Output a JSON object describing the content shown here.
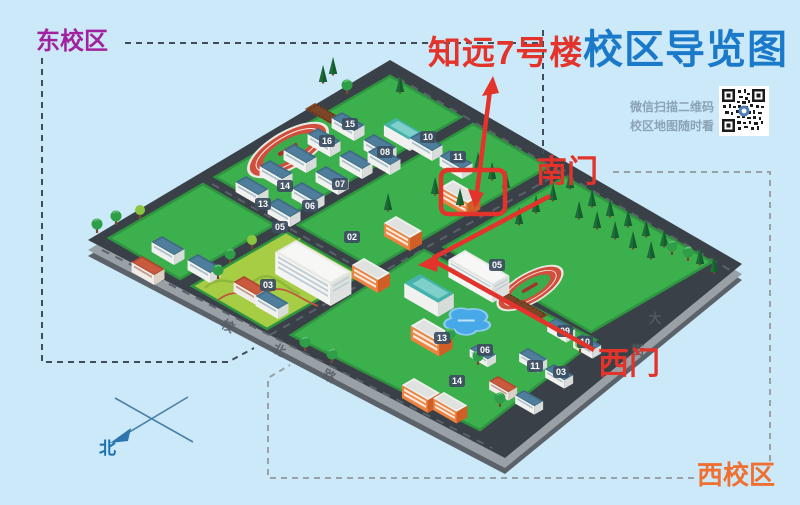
{
  "labels": {
    "title": "校区导览图",
    "highlight": "知远7号楼",
    "south_gate": "南门",
    "west_gate": "西门",
    "east_campus": "东校区",
    "west_campus": "西校区",
    "qr_line1": "微信扫描二维码",
    "qr_line2": "校区地图随时看",
    "north": "北"
  },
  "map": {
    "badges_east": [
      "15",
      "16",
      "08",
      "10",
      "11",
      "07",
      "06",
      "05",
      "14",
      "13",
      "03",
      "02"
    ],
    "badges_west": [
      "05",
      "13",
      "06",
      "09",
      "10",
      "11",
      "03",
      "14"
    ],
    "road_labels": [
      "校",
      "北",
      "路",
      "大",
      "街"
    ]
  },
  "colors": {
    "background": "#cbe9f9",
    "title_blue": "#1a79c9",
    "callout_red": "#e3332b",
    "east_campus_magenta": "#a2219e",
    "west_campus_orange": "#ef7031",
    "road_dark": "#3a4047",
    "campus_green": "#3cb04d",
    "lawn_yellow_green": "#a6cd44",
    "lake_blue": "#47a8e8",
    "track_red": "#d24e3c",
    "compass_blue": "#2e74ad",
    "qr_caption_gray": "#8ba3b6"
  }
}
